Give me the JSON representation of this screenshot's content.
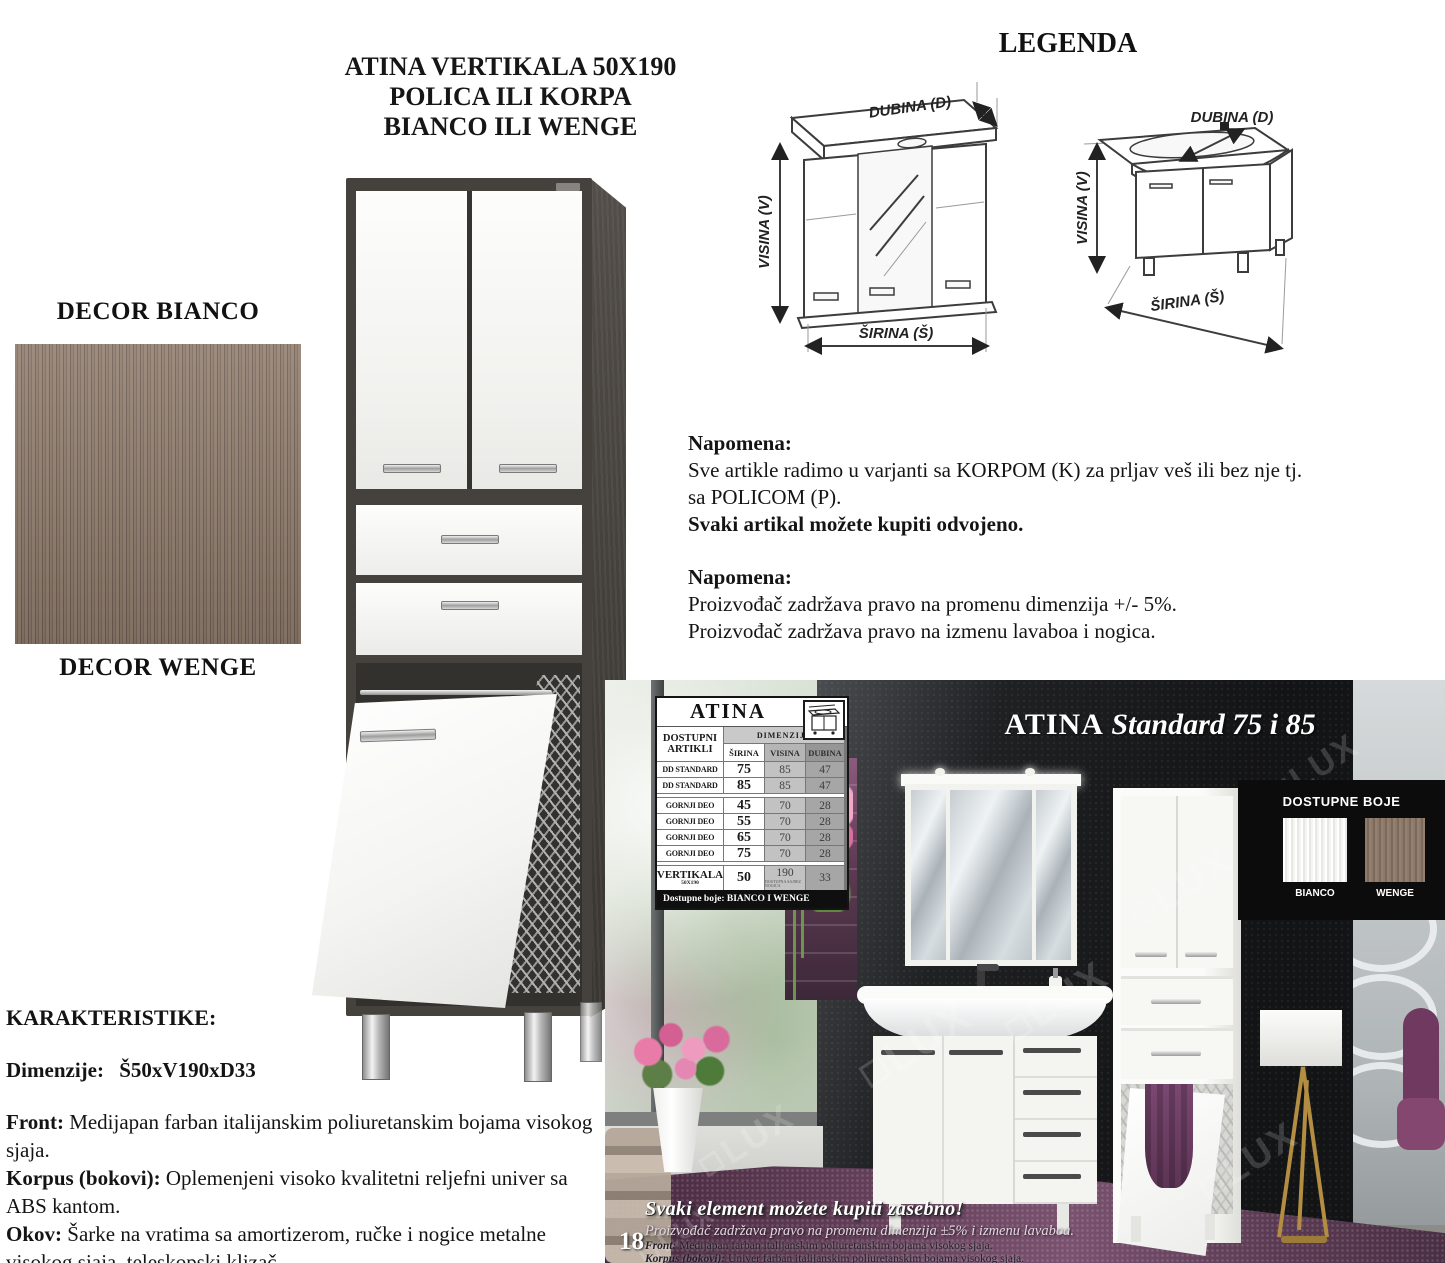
{
  "colors": {
    "bianco_swatch": "#f7f7f5",
    "wenge_swatch": "#87746a",
    "cabinet_frame": "#45423d",
    "photo_wall": "#1d1e20",
    "accent_purple": "#6b4560"
  },
  "decor": {
    "bianco_label": "DECOR BIANCO",
    "wenge_label": "DECOR WENGE"
  },
  "product_title": {
    "line1": "ATINA VERTIKALA 50X190",
    "line2": "POLICA ILI KORPA",
    "line3": "BIANCO ILI WENGE"
  },
  "legend": {
    "title": "LEGENDA",
    "depth_label": "DUBINA (D)",
    "height_label": "VISINA (V)",
    "width_label": "ŠIRINA (Š)"
  },
  "notes": {
    "first_heading": "Napomena:",
    "first_line1": "Sve artikle radimo u varjanti sa KORPOM (K) za prljav veš ili bez nje tj.",
    "first_line2": "sa POLICOM (P).",
    "first_bold": "Svaki artikal možete kupiti odvojeno.",
    "second_heading": "Napomena:",
    "second_line1": "Proizvođač zadržava pravo na promenu dimenzija +/- 5%.",
    "second_line2": "Proizvođač zadržava pravo na izmenu lavaboa i nogica."
  },
  "characteristics": {
    "heading": "KARAKTERISTIKE:",
    "dim_label": "Dimenzije:",
    "dim_value": "Š50xV190xD33",
    "front_label": "Front:",
    "front_text": " Medijapan farban italijanskim poliuretanskim bojama visokog sjaja.",
    "korpus_label": "Korpus (bokovi):",
    "korpus_text": " Oplemenjeni visoko kvalitetni reljefni univer sa ABS kantom.",
    "okov_label": "Okov:",
    "okov_text": " Šarke na vratima sa amortizerom, ručke i nogice metalne visokog sjaja, teleskopski klizač."
  },
  "photo": {
    "page_number": "18",
    "title_brand": "ATINA",
    "title_rest": " Standard 75 i 85",
    "watermark": "LUX",
    "colors_panel": {
      "title": "DOSTUPNE BOJE",
      "bianco": "BIANCO",
      "wenge": "WENGE"
    },
    "table": {
      "brand": "ATINA",
      "left_header": "DOSTUPNI ARTIKLI",
      "dim_header": "DIMENZIJE",
      "col1": "ŠIRINA",
      "col2": "VISINA",
      "col3": "DUBINA",
      "rows": [
        {
          "name": "DD STANDARD",
          "s": "75",
          "v": "85",
          "d": "47"
        },
        {
          "name": "DD STANDARD",
          "s": "85",
          "v": "85",
          "d": "47"
        },
        {
          "name": "GORNJI DEO",
          "s": "45",
          "v": "70",
          "d": "28"
        },
        {
          "name": "GORNJI DEO",
          "s": "55",
          "v": "70",
          "d": "28"
        },
        {
          "name": "GORNJI DEO",
          "s": "65",
          "v": "70",
          "d": "28"
        },
        {
          "name": "GORNJI DEO",
          "s": "75",
          "v": "70",
          "d": "28"
        },
        {
          "name": "VERTIKALA",
          "sub": "50X190",
          "s": "50",
          "v": "190",
          "v_note": "DOSTUPNA SA/BEZ NOGICA",
          "d": "33"
        }
      ],
      "footer": "Dostupne boje: BIANCO I WENGE"
    },
    "footer": {
      "bold": "Svaki element možete kupiti zasebno!",
      "italic": "Proizvođač zadržava pravo na promenu dimenzija ±5% i izmenu lavaboa.",
      "front_label": "Front:",
      "front_text": " Medijapan farban italijanskim poliuretanskim bojama visokog sjaja.",
      "korpus_label": "Korpus (bokovi):",
      "korpus_text": " Univer farban italijanskim poliuretanskim bojama visokog sjaja."
    }
  }
}
